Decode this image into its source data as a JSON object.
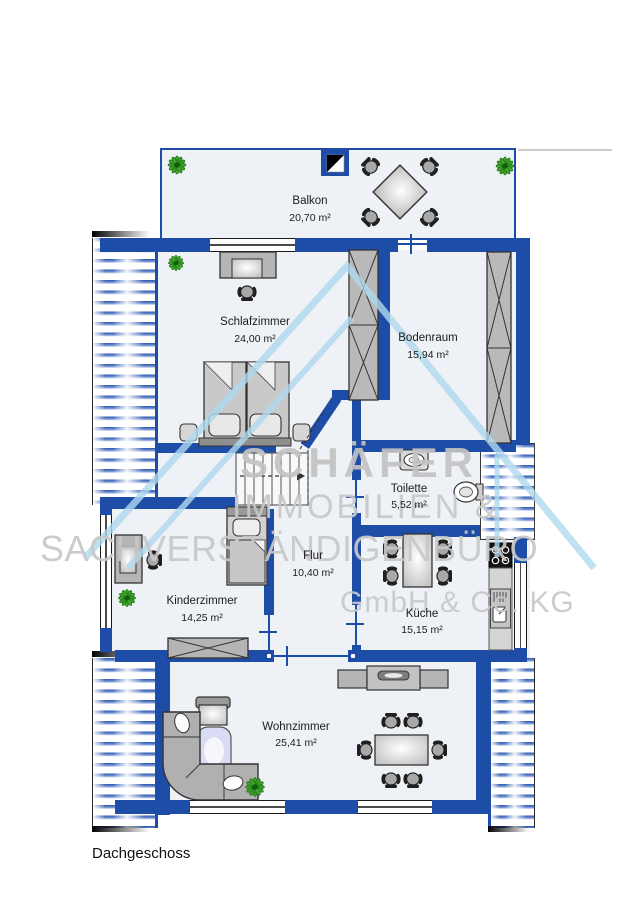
{
  "floor_label": "Dachgeschoss",
  "rooms": [
    {
      "name": "Balkon",
      "area": "20,70 m²"
    },
    {
      "name": "Schlafzimmer",
      "area": "24,00 m²"
    },
    {
      "name": "Bodenraum",
      "area": "15,94 m²"
    },
    {
      "name": "Toilette",
      "area": "5,52 m²"
    },
    {
      "name": "Flur",
      "area": "10,40 m²"
    },
    {
      "name": "Kinderzimmer",
      "area": "14,25 m²"
    },
    {
      "name": "Küche",
      "area": "15,15 m²"
    },
    {
      "name": "Wohnzimmer",
      "area": "25,41 m²"
    }
  ],
  "watermark": {
    "line1": "SCHÄFER",
    "line2": "IMMOBILIEN &",
    "line3": "SACHVERSTÄNDIGENBÜRO",
    "line4": "GmbH & Co. KG"
  },
  "colors": {
    "wall_blue": "#1e4da8",
    "hatch_blue": "#2a57ae",
    "floor": "#eef1f6",
    "watermark_blue": "#b0d9ee",
    "watermark_gray": "#c8c8c8",
    "plant_green": "#43a32e"
  },
  "icons": [
    "plant-icon",
    "north-indicator-icon",
    "stairs-icon",
    "stove-icon",
    "sink-icon",
    "toilet-icon"
  ]
}
